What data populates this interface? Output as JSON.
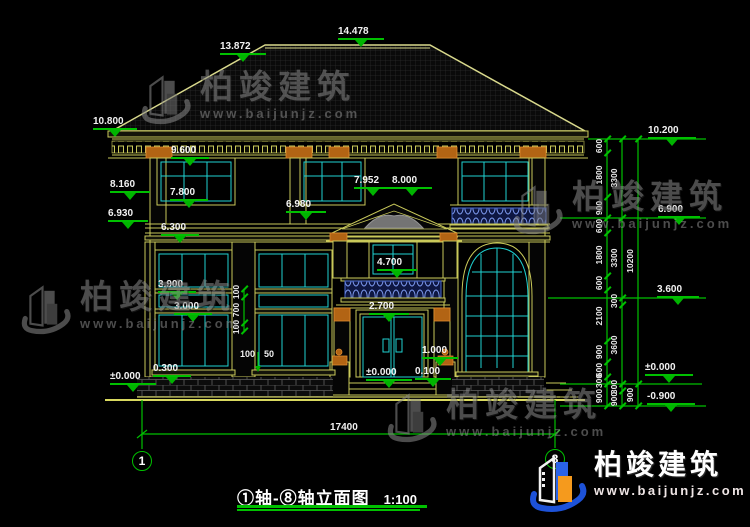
{
  "drawing_title": {
    "text": "①轴-⑧轴立面图",
    "scale": "1:100"
  },
  "brand": {
    "name": "柏竣建筑",
    "url": "www.baijunjz.com"
  },
  "overall_dim": {
    "text": "17400"
  },
  "axis_bubbles": [
    {
      "label": "1",
      "x": 142,
      "y": 461
    },
    {
      "label": "8",
      "x": 555,
      "y": 459
    }
  ],
  "elevation_marks": [
    {
      "label": "13.872",
      "x": 220,
      "y": 41,
      "lw": 46
    },
    {
      "label": "14.478",
      "x": 338,
      "y": 26,
      "lw": 46
    },
    {
      "label": "10.800",
      "x": 93,
      "y": 116,
      "lw": 44
    },
    {
      "label": "8.160",
      "x": 110,
      "y": 179,
      "lw": 40
    },
    {
      "label": "6.930",
      "x": 108,
      "y": 208,
      "lw": 40
    },
    {
      "label": "±0.000",
      "x": 110,
      "y": 371,
      "lw": 46
    },
    {
      "label": "9.600",
      "x": 171,
      "y": 145,
      "lw": 38
    },
    {
      "label": "7.800",
      "x": 170,
      "y": 187,
      "lw": 38
    },
    {
      "label": "6.300",
      "x": 161,
      "y": 222,
      "lw": 38
    },
    {
      "label": "3.900",
      "x": 158,
      "y": 279,
      "lw": 38
    },
    {
      "label": "3.000",
      "x": 174,
      "y": 301,
      "lw": 38
    },
    {
      "label": "0.300",
      "x": 153,
      "y": 363,
      "lw": 38
    },
    {
      "label": "7.952",
      "x": 354,
      "y": 175,
      "lw": 38
    },
    {
      "label": "8.000",
      "x": 392,
      "y": 175,
      "lw": 40
    },
    {
      "label": "6.980",
      "x": 286,
      "y": 199,
      "lw": 40
    },
    {
      "label": "4.700",
      "x": 377,
      "y": 257,
      "lw": 40
    },
    {
      "label": "2.700",
      "x": 369,
      "y": 301,
      "lw": 40
    },
    {
      "label": "1.000",
      "x": 422,
      "y": 345,
      "lw": 36
    },
    {
      "label": "0.100",
      "x": 415,
      "y": 366,
      "lw": 36
    },
    {
      "label": "±0.000",
      "x": 366,
      "y": 367,
      "lw": 46
    },
    {
      "label": "10.200",
      "x": 648,
      "y": 125,
      "lw": 48
    },
    {
      "label": "6.900",
      "x": 658,
      "y": 204,
      "lw": 42
    },
    {
      "label": "3.600",
      "x": 657,
      "y": 284,
      "lw": 42
    },
    {
      "label": "±0.000",
      "x": 645,
      "y": 362,
      "lw": 48
    },
    {
      "label": "-0.900",
      "x": 647,
      "y": 391,
      "lw": 48
    }
  ],
  "dim_chains": [
    {
      "x": 607,
      "ticks": [
        139,
        153,
        197,
        218,
        233,
        276,
        290,
        341,
        362,
        377,
        384,
        406
      ],
      "labels": [
        {
          "v": "600",
          "y": 146
        },
        {
          "v": "1800",
          "y": 175
        },
        {
          "v": "900",
          "y": 208
        },
        {
          "v": "600",
          "y": 226
        },
        {
          "v": "1800",
          "y": 255
        },
        {
          "v": "600",
          "y": 283
        },
        {
          "v": "2100",
          "y": 316
        },
        {
          "v": "900",
          "y": 352
        },
        {
          "v": "600",
          "y": 370
        },
        {
          "v": "300",
          "y": 381
        },
        {
          "v": "900",
          "y": 396
        }
      ]
    },
    {
      "x": 622,
      "ticks": [
        139,
        218,
        298,
        305,
        384,
        391,
        406
      ],
      "labels": [
        {
          "v": "3300",
          "y": 178
        },
        {
          "v": "3300",
          "y": 258
        },
        {
          "v": "300",
          "y": 301
        },
        {
          "v": "3600",
          "y": 345
        },
        {
          "v": "300",
          "y": 387
        },
        {
          "v": "900",
          "y": 399
        }
      ]
    },
    {
      "x": 638,
      "ticks": [
        139,
        384,
        406
      ],
      "labels": [
        {
          "v": "10200",
          "y": 261
        },
        {
          "v": "900",
          "y": 395
        }
      ]
    },
    {
      "x": 244,
      "ticks": [
        289,
        297,
        323,
        331
      ],
      "labels": [
        {
          "v": "100",
          "y": 292
        },
        {
          "v": "700",
          "y": 310
        },
        {
          "v": "100",
          "y": 327
        }
      ]
    }
  ],
  "free_dims": [
    {
      "text": "100",
      "x": 240,
      "y": 349
    },
    {
      "text": "50",
      "x": 264,
      "y": 349
    }
  ],
  "watermarks": {
    "positions": [
      {
        "x": 140,
        "y": 70
      },
      {
        "x": 20,
        "y": 280
      },
      {
        "x": 386,
        "y": 388
      },
      {
        "x": 512,
        "y": 180
      }
    ]
  },
  "colors": {
    "line_yellow": "#c9c95a",
    "window_cyan": "#1fd2d2",
    "dim_green": "#00c000",
    "accent_orange": "#c97a28",
    "balustrade_blue": "#4a6ad0"
  }
}
